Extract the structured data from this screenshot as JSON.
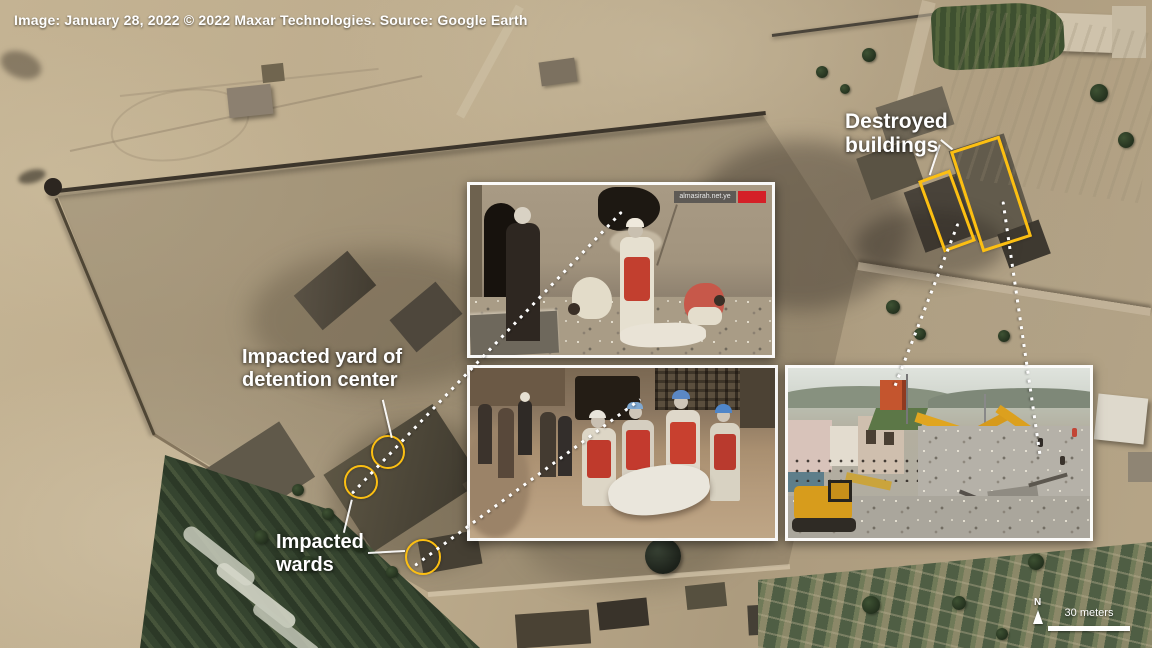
{
  "caption": "Image: January 28, 2022 © 2022 Maxar Technologies. Source: Google Earth",
  "labels": {
    "destroyed_buildings": "Destroyed buildings",
    "impacted_yard": "Impacted yard of detention center",
    "impacted_wards": "Impacted wards"
  },
  "scalebar": {
    "north": "N",
    "distance": "30 meters"
  },
  "photos": {
    "top": {
      "watermark": "almasirah.net.ye"
    }
  },
  "colors": {
    "highlight_yellow": "#fcbf12",
    "annotation_white": "#ffffff"
  }
}
